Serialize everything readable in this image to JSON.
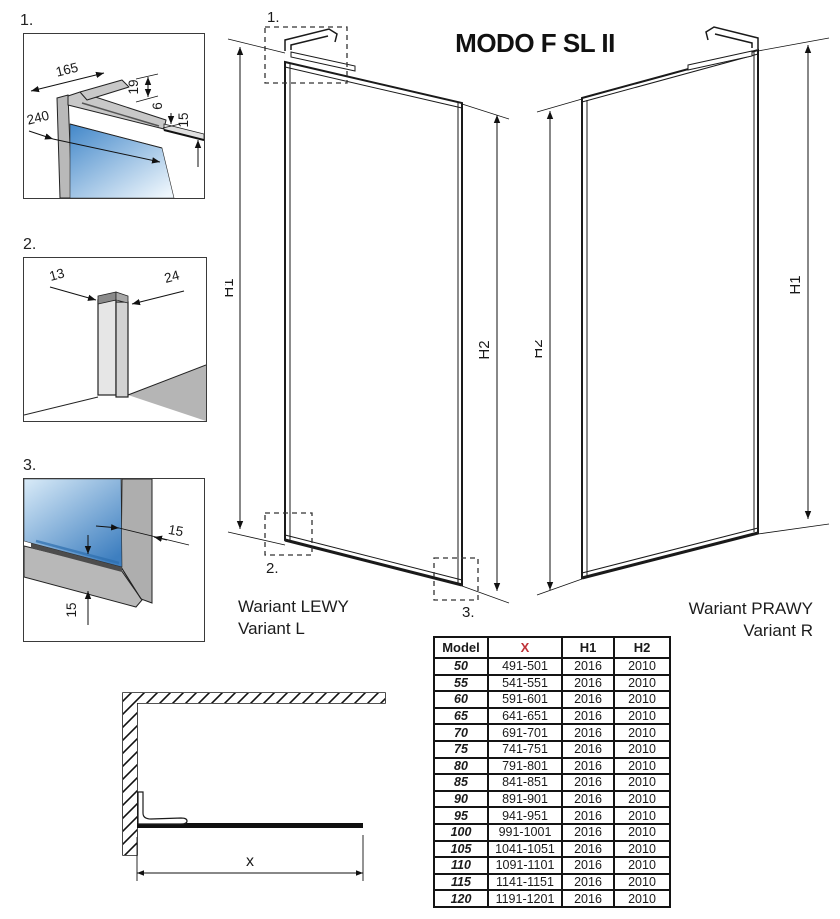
{
  "title": "MODO F SL II",
  "details": {
    "d1": {
      "label": "1.",
      "dims": [
        "165",
        "19",
        "240",
        "6",
        "15"
      ]
    },
    "d2": {
      "label": "2.",
      "dims": [
        "13",
        "24"
      ]
    },
    "d3": {
      "label": "3.",
      "dims": [
        "15",
        "15"
      ]
    }
  },
  "panel_left": {
    "callouts": [
      "1.",
      "2.",
      "3."
    ],
    "h1": "H1",
    "h2": "H2",
    "caption_pl": "Wariant LEWY",
    "caption_en": "Variant L"
  },
  "panel_right": {
    "h1": "H1",
    "h2": "H2",
    "caption_pl": "Wariant PRAWY",
    "caption_en": "Variant R"
  },
  "plan": {
    "width_label": "x"
  },
  "table": {
    "headers": [
      "Model",
      "X",
      "H1",
      "H2"
    ],
    "rows": [
      [
        "50",
        "491-501",
        "2016",
        "2010"
      ],
      [
        "55",
        "541-551",
        "2016",
        "2010"
      ],
      [
        "60",
        "591-601",
        "2016",
        "2010"
      ],
      [
        "65",
        "641-651",
        "2016",
        "2010"
      ],
      [
        "70",
        "691-701",
        "2016",
        "2010"
      ],
      [
        "75",
        "741-751",
        "2016",
        "2010"
      ],
      [
        "80",
        "791-801",
        "2016",
        "2010"
      ],
      [
        "85",
        "841-851",
        "2016",
        "2010"
      ],
      [
        "90",
        "891-901",
        "2016",
        "2010"
      ],
      [
        "95",
        "941-951",
        "2016",
        "2010"
      ],
      [
        "100",
        "991-1001",
        "2016",
        "2010"
      ],
      [
        "105",
        "1041-1051",
        "2016",
        "2010"
      ],
      [
        "110",
        "1091-1101",
        "2016",
        "2010"
      ],
      [
        "115",
        "1141-1151",
        "2016",
        "2010"
      ],
      [
        "120",
        "1191-1201",
        "2016",
        "2010"
      ]
    ]
  },
  "colors": {
    "accent_red_table": "#bf3238",
    "accent_red_plan": "#c9504c",
    "glass_blue_dark": "#3f83c6",
    "glass_blue_light": "#e8f3fb",
    "frame_gray": "#b5b5b5",
    "line_black": "#1a1a1a"
  }
}
